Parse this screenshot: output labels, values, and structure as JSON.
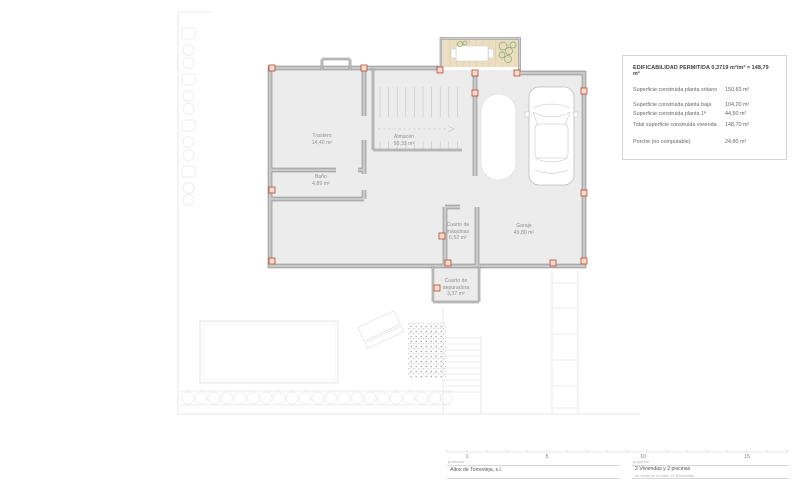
{
  "info_box": {
    "title": "EDIFICABILIDAD PERMITIDA 0,3719 m²/m² = 148,79 m²",
    "rows": [
      {
        "label": "Superficie construida planta sótano",
        "value": "150,83 m²"
      },
      {
        "label": "Superficie construida planta baja",
        "value": "104,20 m²"
      },
      {
        "label": "Superficie construida planta 1ª",
        "value": "44,50 m²"
      },
      {
        "label": "Total superficie construida vivienda",
        "value": "148,70 m²"
      },
      {
        "label": "Porche (no computable)",
        "value": "24,80 m²"
      }
    ]
  },
  "rooms": {
    "trastero": {
      "name": "Trastero",
      "area": "14,40 m²"
    },
    "almacen": {
      "name": "Almacén",
      "area": "50,33 m²"
    },
    "bano": {
      "name": "Baño",
      "area": "4,89 m²"
    },
    "maquinas": {
      "name1": "Cuarto de",
      "name2": "máquinas",
      "area": "6,52 m²"
    },
    "garaje": {
      "name": "Garaje",
      "area": "49,80 m²"
    },
    "depuradora": {
      "name1": "Cuarto de",
      "name2": "depuradora",
      "area": "3,37 m²"
    }
  },
  "scale_bar": {
    "labels": [
      "1",
      "5",
      "10",
      "15"
    ]
  },
  "title_block": {
    "promotor_label": "promotor",
    "promotor": "Altos de Torrevieja, s.l.",
    "proyecto_label": "proyecto",
    "proyecto": "2 Viviendas y 2 piscinas",
    "address": "av. lomas de la costa, 21-B torrevieja"
  },
  "colors": {
    "wall-dark": "#8d8d8d",
    "wall-fill": "#c9c9c9",
    "plan-fill": "#ececec",
    "column-red": "#b5492f",
    "column-fill": "#f3d9d0",
    "porch-tan": "#ebdec1",
    "porch-grid": "#d9c7a3",
    "plant-green": "#82a96d",
    "line-light": "#dcdcdc",
    "line-faint": "#e8e8e8"
  }
}
